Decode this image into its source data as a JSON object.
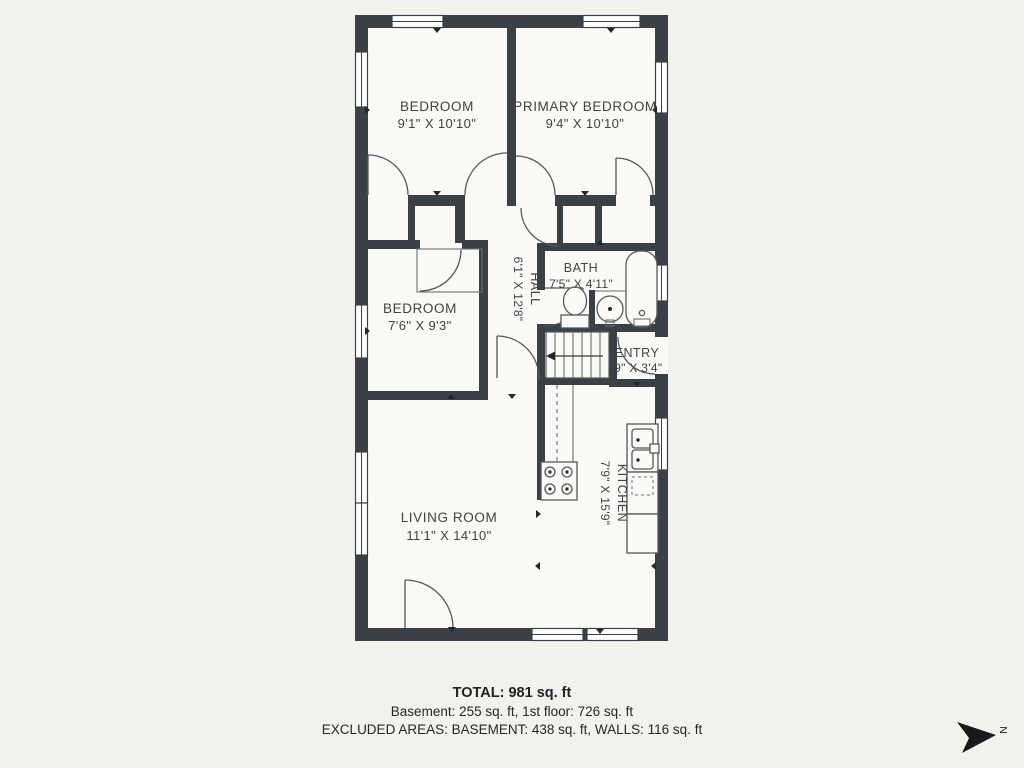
{
  "canvas": {
    "background": "#f2f1ec",
    "floor": "#faf9f5",
    "wall_color": "#3b4046",
    "line_color": "#53585d",
    "text_color": "#3d434a"
  },
  "rooms": [
    {
      "id": "bedroom-top-left",
      "label": "BEDROOM",
      "dims": "9'1\" X 10'10\""
    },
    {
      "id": "primary-bedroom",
      "label": "PRIMARY BEDROOM",
      "dims": "9'4\" X 10'10\""
    },
    {
      "id": "bedroom-middle",
      "label": "BEDROOM",
      "dims": "7'6\" X 9'3\""
    },
    {
      "id": "hall",
      "label": "HALL",
      "dims": "6'1\" X 12'8\""
    },
    {
      "id": "bath",
      "label": "BATH",
      "dims": "7'5\" X 4'11\""
    },
    {
      "id": "entry",
      "label": "ENTRY",
      "dims": "'9\" X 3'4\""
    },
    {
      "id": "kitchen",
      "label": "KITCHEN",
      "dims": "7'9\" X 15'9\""
    },
    {
      "id": "living-room",
      "label": "LIVING ROOM",
      "dims": "11'1\" X 14'10\""
    }
  ],
  "summary": {
    "total": "TOTAL: 981 sq. ft",
    "floors": "Basement: 255 sq. ft, 1st floor: 726 sq. ft",
    "excluded": "EXCLUDED AREAS: BASEMENT: 438 sq. ft, WALLS: 116 sq. ft"
  },
  "compass": {
    "label": "N"
  }
}
